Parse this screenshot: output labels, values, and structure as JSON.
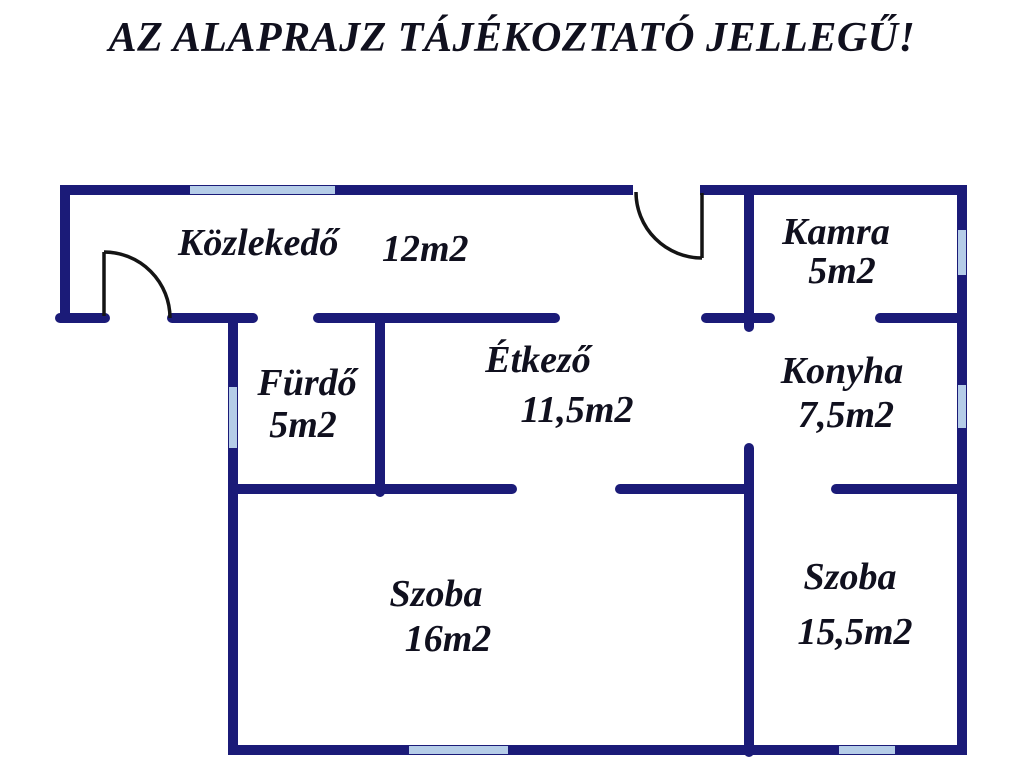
{
  "title": "AZ ALAPRAJZ TÁJÉKOZTATÓ JELLEGŰ!",
  "plan": {
    "rooms": [
      {
        "id": "kozlekedo",
        "name": "Közlekedő",
        "area": "12m2"
      },
      {
        "id": "kamra",
        "name": "Kamra",
        "area": "5m2"
      },
      {
        "id": "furdo",
        "name": "Fürdő",
        "area": "5m2"
      },
      {
        "id": "etkezo",
        "name": "Étkező",
        "area": "11,5m2"
      },
      {
        "id": "konyha",
        "name": "Konyha",
        "area": "7,5m2"
      },
      {
        "id": "szoba-1",
        "name": "Szoba",
        "area": "16m2"
      },
      {
        "id": "szoba-2",
        "name": "Szoba",
        "area": "15,5m2"
      }
    ]
  },
  "colors": {
    "wall": "#1b1b78",
    "window": "#b5cde8",
    "door": "#141414",
    "text": "#10101e",
    "background": "#ffffff"
  }
}
